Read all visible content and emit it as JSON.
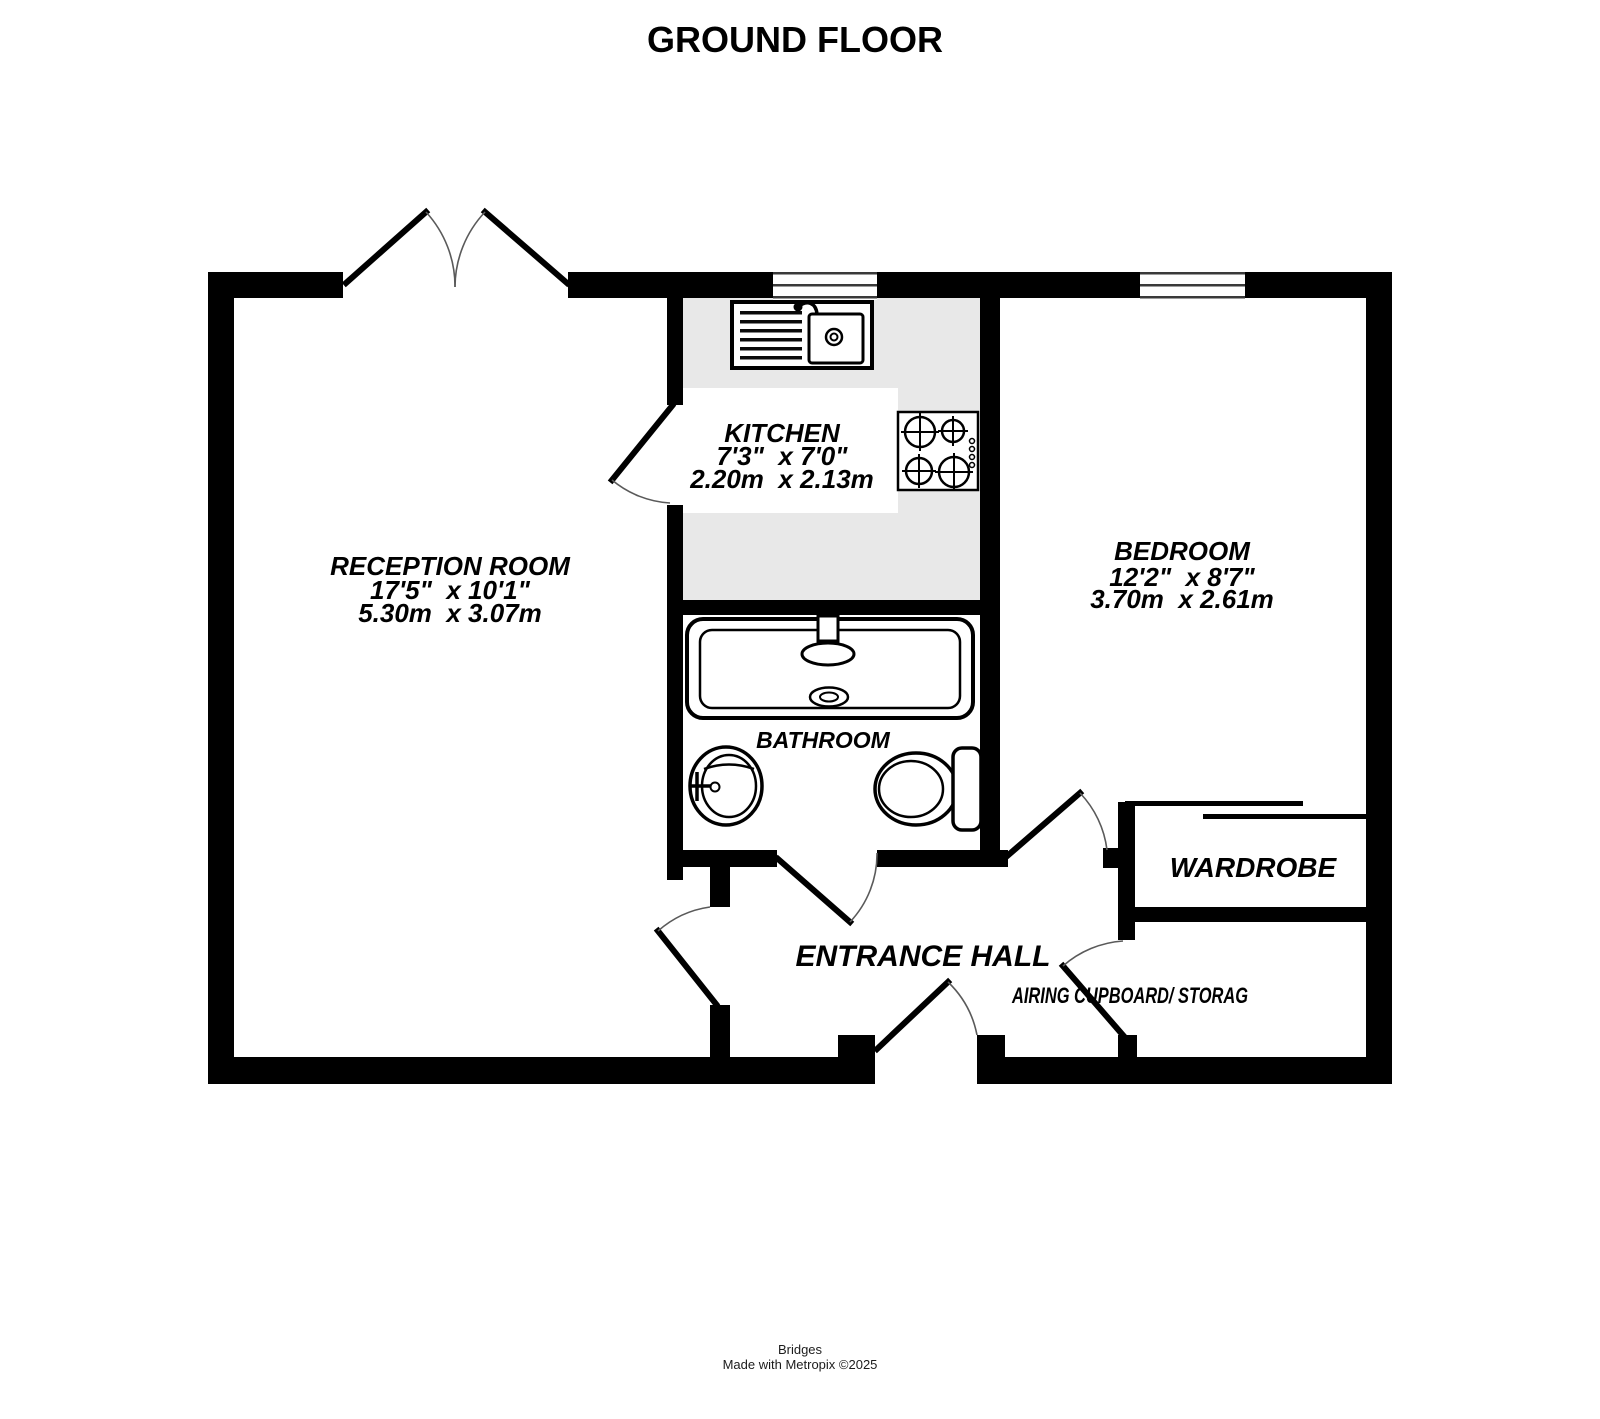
{
  "title": "GROUND FLOOR",
  "rooms": {
    "reception": {
      "name": "RECEPTION ROOM",
      "imperial": "17'5\"  x 10'1\"",
      "metric": "5.30m  x 3.07m"
    },
    "kitchen": {
      "name": "KITCHEN",
      "imperial": "7'3\"  x 7'0\"",
      "metric": "2.20m  x 2.13m"
    },
    "bedroom": {
      "name": "BEDROOM",
      "imperial": "12'2\"  x 8'7\"",
      "metric": "3.70m  x 2.61m"
    },
    "bathroom": {
      "name": "BATHROOM"
    },
    "entrance_hall": {
      "name": "ENTRANCE HALL"
    },
    "wardrobe": {
      "name": "WARDROBE"
    },
    "airing_cupboard": {
      "name": "AIRING CUPBOARD/ STORAG"
    }
  },
  "footer": {
    "brand": "Bridges",
    "credit": "Made with Metropix ©2025"
  },
  "colors": {
    "wall": "#000000",
    "counter": "#e8e8e8",
    "door_arc": "#5a5a5a",
    "background": "#ffffff"
  }
}
